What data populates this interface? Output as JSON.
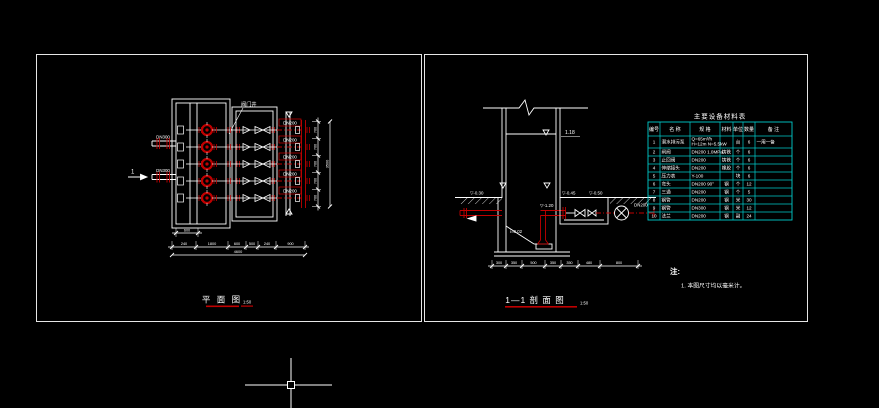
{
  "canvas": {
    "width": 879,
    "height": 408,
    "background": "#000000"
  },
  "colors": {
    "line": "#ffffff",
    "pipe_red": "#c00000",
    "label_red": "#d40000",
    "table_teal": "#00cccc"
  },
  "left_panel": {
    "title": "平 面 图",
    "scale": "1:50",
    "callout_label": "阀门井",
    "section_marker": "1",
    "inlets": [
      {
        "label": "DN300"
      },
      {
        "label": "DN300"
      }
    ],
    "pump_rows": [
      {
        "pipe_label": "DN200"
      },
      {
        "pipe_label": "DN200"
      },
      {
        "pipe_label": "DN200"
      },
      {
        "pipe_label": "DN200"
      },
      {
        "pipe_label": "DN200"
      }
    ],
    "dims": {
      "well_width": "600",
      "bottom_segments": [
        "240",
        "1800",
        "600",
        "500",
        "240",
        "900"
      ],
      "bottom_total": "4600",
      "right_segments": [
        "700",
        "700",
        "700",
        "700",
        "700"
      ],
      "right_total": "3500"
    }
  },
  "right_panel": {
    "title": "1—1 剖 面 图",
    "scale": "1:50",
    "elevation_top": "1.18",
    "slope_label": "i=0.02",
    "pipe_label": "DN200",
    "elevations": [
      "▽-0.30",
      "▽-1.20",
      "▽-0.45",
      "▽-0.50"
    ],
    "dims": {
      "bottom_segments": [
        "300",
        "350",
        "500",
        "350",
        "350",
        "480",
        "800"
      ]
    },
    "table": {
      "title": "主要设备材料表",
      "headers": [
        "编号",
        "名  称",
        "规  格",
        "材料",
        "单位",
        "数量",
        "备  注"
      ],
      "rows": [
        [
          "1",
          "潜水排污泵",
          "Q=65m³/h\nH=12m N=5.5kW",
          "",
          "台",
          "6",
          "一用一备"
        ],
        [
          "2",
          "闸阀",
          "DN200  1.0MPa",
          "铸铁",
          "个",
          "6",
          ""
        ],
        [
          "3",
          "止回阀",
          "DN200",
          "铸铁",
          "个",
          "6",
          ""
        ],
        [
          "4",
          "伸缩接头",
          "DN200",
          "橡胶",
          "个",
          "6",
          ""
        ],
        [
          "5",
          "压力表",
          "Y-100",
          "",
          "块",
          "6",
          ""
        ],
        [
          "6",
          "弯头",
          "DN200  90°",
          "钢",
          "个",
          "12",
          ""
        ],
        [
          "7",
          "三通",
          "DN200",
          "钢",
          "个",
          "5",
          ""
        ],
        [
          "8",
          "钢管",
          "DN200",
          "钢",
          "米",
          "30",
          ""
        ],
        [
          "9",
          "钢管",
          "DN300",
          "钢",
          "米",
          "12",
          ""
        ],
        [
          "10",
          "法兰",
          "DN200",
          "钢",
          "副",
          "24",
          ""
        ]
      ]
    },
    "notes": {
      "label": "注:",
      "items": [
        "1. 本图尺寸均以毫米计。"
      ]
    }
  },
  "cursor": {
    "x": 291,
    "y": 385
  }
}
